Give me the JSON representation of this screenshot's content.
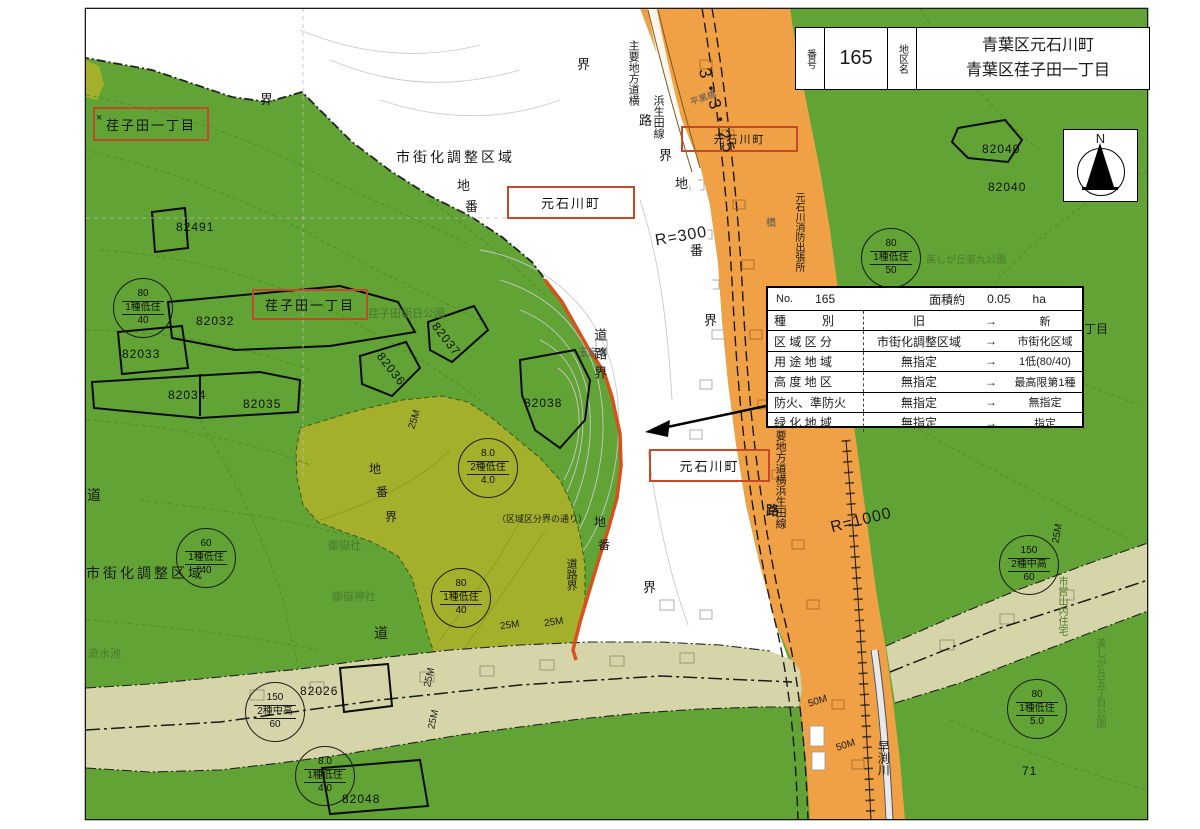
{
  "title_block": {
    "no_label": "番号",
    "no_value": "165",
    "district_label": "地区名",
    "district_line1": "青葉区元石川町",
    "district_line2": "青葉区荏子田一丁目"
  },
  "compass": {
    "north": "N"
  },
  "change_table": {
    "no_label": "No.",
    "no_value": "165",
    "area_label": "面積約",
    "area_value": "0.05",
    "area_unit": "ha",
    "rows": [
      {
        "item": "種　　　別",
        "old": "旧",
        "arrow": "→",
        "new": "新"
      },
      {
        "item": "区 域 区 分",
        "old": "市街化調整区域",
        "arrow": "→",
        "new": "市街化区域"
      },
      {
        "item": "用 途 地 域",
        "old": "無指定",
        "arrow": "→",
        "new": "1低(80/40)"
      },
      {
        "item": "高 度 地 区",
        "old": "無指定",
        "arrow": "→",
        "new": "最高限第1種"
      },
      {
        "item": "防火、準防火",
        "old": "無指定",
        "arrow": "→",
        "new": "無指定"
      },
      {
        "item": "緑 化 地 域",
        "old": "無指定",
        "arrow": "→",
        "new": "指定"
      }
    ]
  },
  "boxed_labels": {
    "ekoda_1": "荏子田一丁目",
    "ekoda_2": "荏子田一丁目",
    "motoishikawa_top": "元石川町",
    "motoishikawa_center": "元石川町",
    "motoishikawa_bottom": "元石川町"
  },
  "zone_circles": {
    "c1": {
      "top": "80",
      "mid": "1種低住",
      "bot": "40"
    },
    "c2": {
      "top": "60",
      "mid": "1種低住",
      "bot": "40"
    },
    "c3": {
      "top": "80",
      "mid": "1種低住",
      "bot": "40"
    },
    "c4": {
      "top": "8.0",
      "mid": "2種低住",
      "bot": "4.0"
    },
    "c5": {
      "top": "150",
      "mid": "2種中高",
      "bot": "60"
    },
    "c6": {
      "top": "8.0",
      "mid": "1種低住",
      "bot": "4.0"
    },
    "c7": {
      "top": "80",
      "mid": "1種低住",
      "bot": "50"
    },
    "c8": {
      "top": "150",
      "mid": "2種中高",
      "bot": "60"
    },
    "c9": {
      "top": "80",
      "mid": "1種低住",
      "bot": "5.0"
    }
  },
  "parcels": {
    "p82491": "82491",
    "p82031": "82037",
    "p82032": "82032",
    "p82033": "82033",
    "p82034": "82034",
    "p82035": "82035",
    "p82036": "82036",
    "p82038": "82038",
    "p82026": "82026",
    "p82048": "82048",
    "p82040a": "82040",
    "p82040b": "82040",
    "p71": "71"
  },
  "labels": {
    "urban_control_top": "市街化調整区域",
    "urban_control_bottom": "市街化調整区域",
    "gyokusenji": "玉泉寺",
    "ontakesha": "御嶽社",
    "ontake_jinja": "御嶽神社",
    "yusuichi": "遊水池",
    "ekoda_asahi_park": "荏子田朝日公園",
    "utsukushigaoka_9_park": "美しが丘第九公園",
    "utsukushigaoka_5_park": "美しが丘五丁目公園",
    "shiei_jutaku": "市営山内住宅",
    "hayabuchi_river": "早渕川",
    "fire_station": "元石川消防出張所",
    "road_name_left_1": "主要地方道横",
    "road_name_left_2": "浜生田線",
    "road_name_right": "要地方道横浜生田線",
    "bridge_small": "平黒橋",
    "bridge_glyph": "橋",
    "r300": "R=300",
    "r1000": "R=1000",
    "route_3325": "3・3・25",
    "m25": "25M",
    "m50": "50M",
    "kuiki_tori": "（区域区分界の通り）",
    "chome_partial": "丁目",
    "kai": "界",
    "chi": "地",
    "ban": "番",
    "michi": "道",
    "ro": "路",
    "dorokai": "道路界",
    "x_mark": "×"
  },
  "map_colors": {
    "urbanized_green": "#61a335",
    "subject_olive": "#a4b02c",
    "roadside_khaki": "#d6d5a9",
    "road_orange": "#f1a145",
    "site_boundary_red": "#d8511c",
    "label_box_red": "#c04a2a"
  }
}
